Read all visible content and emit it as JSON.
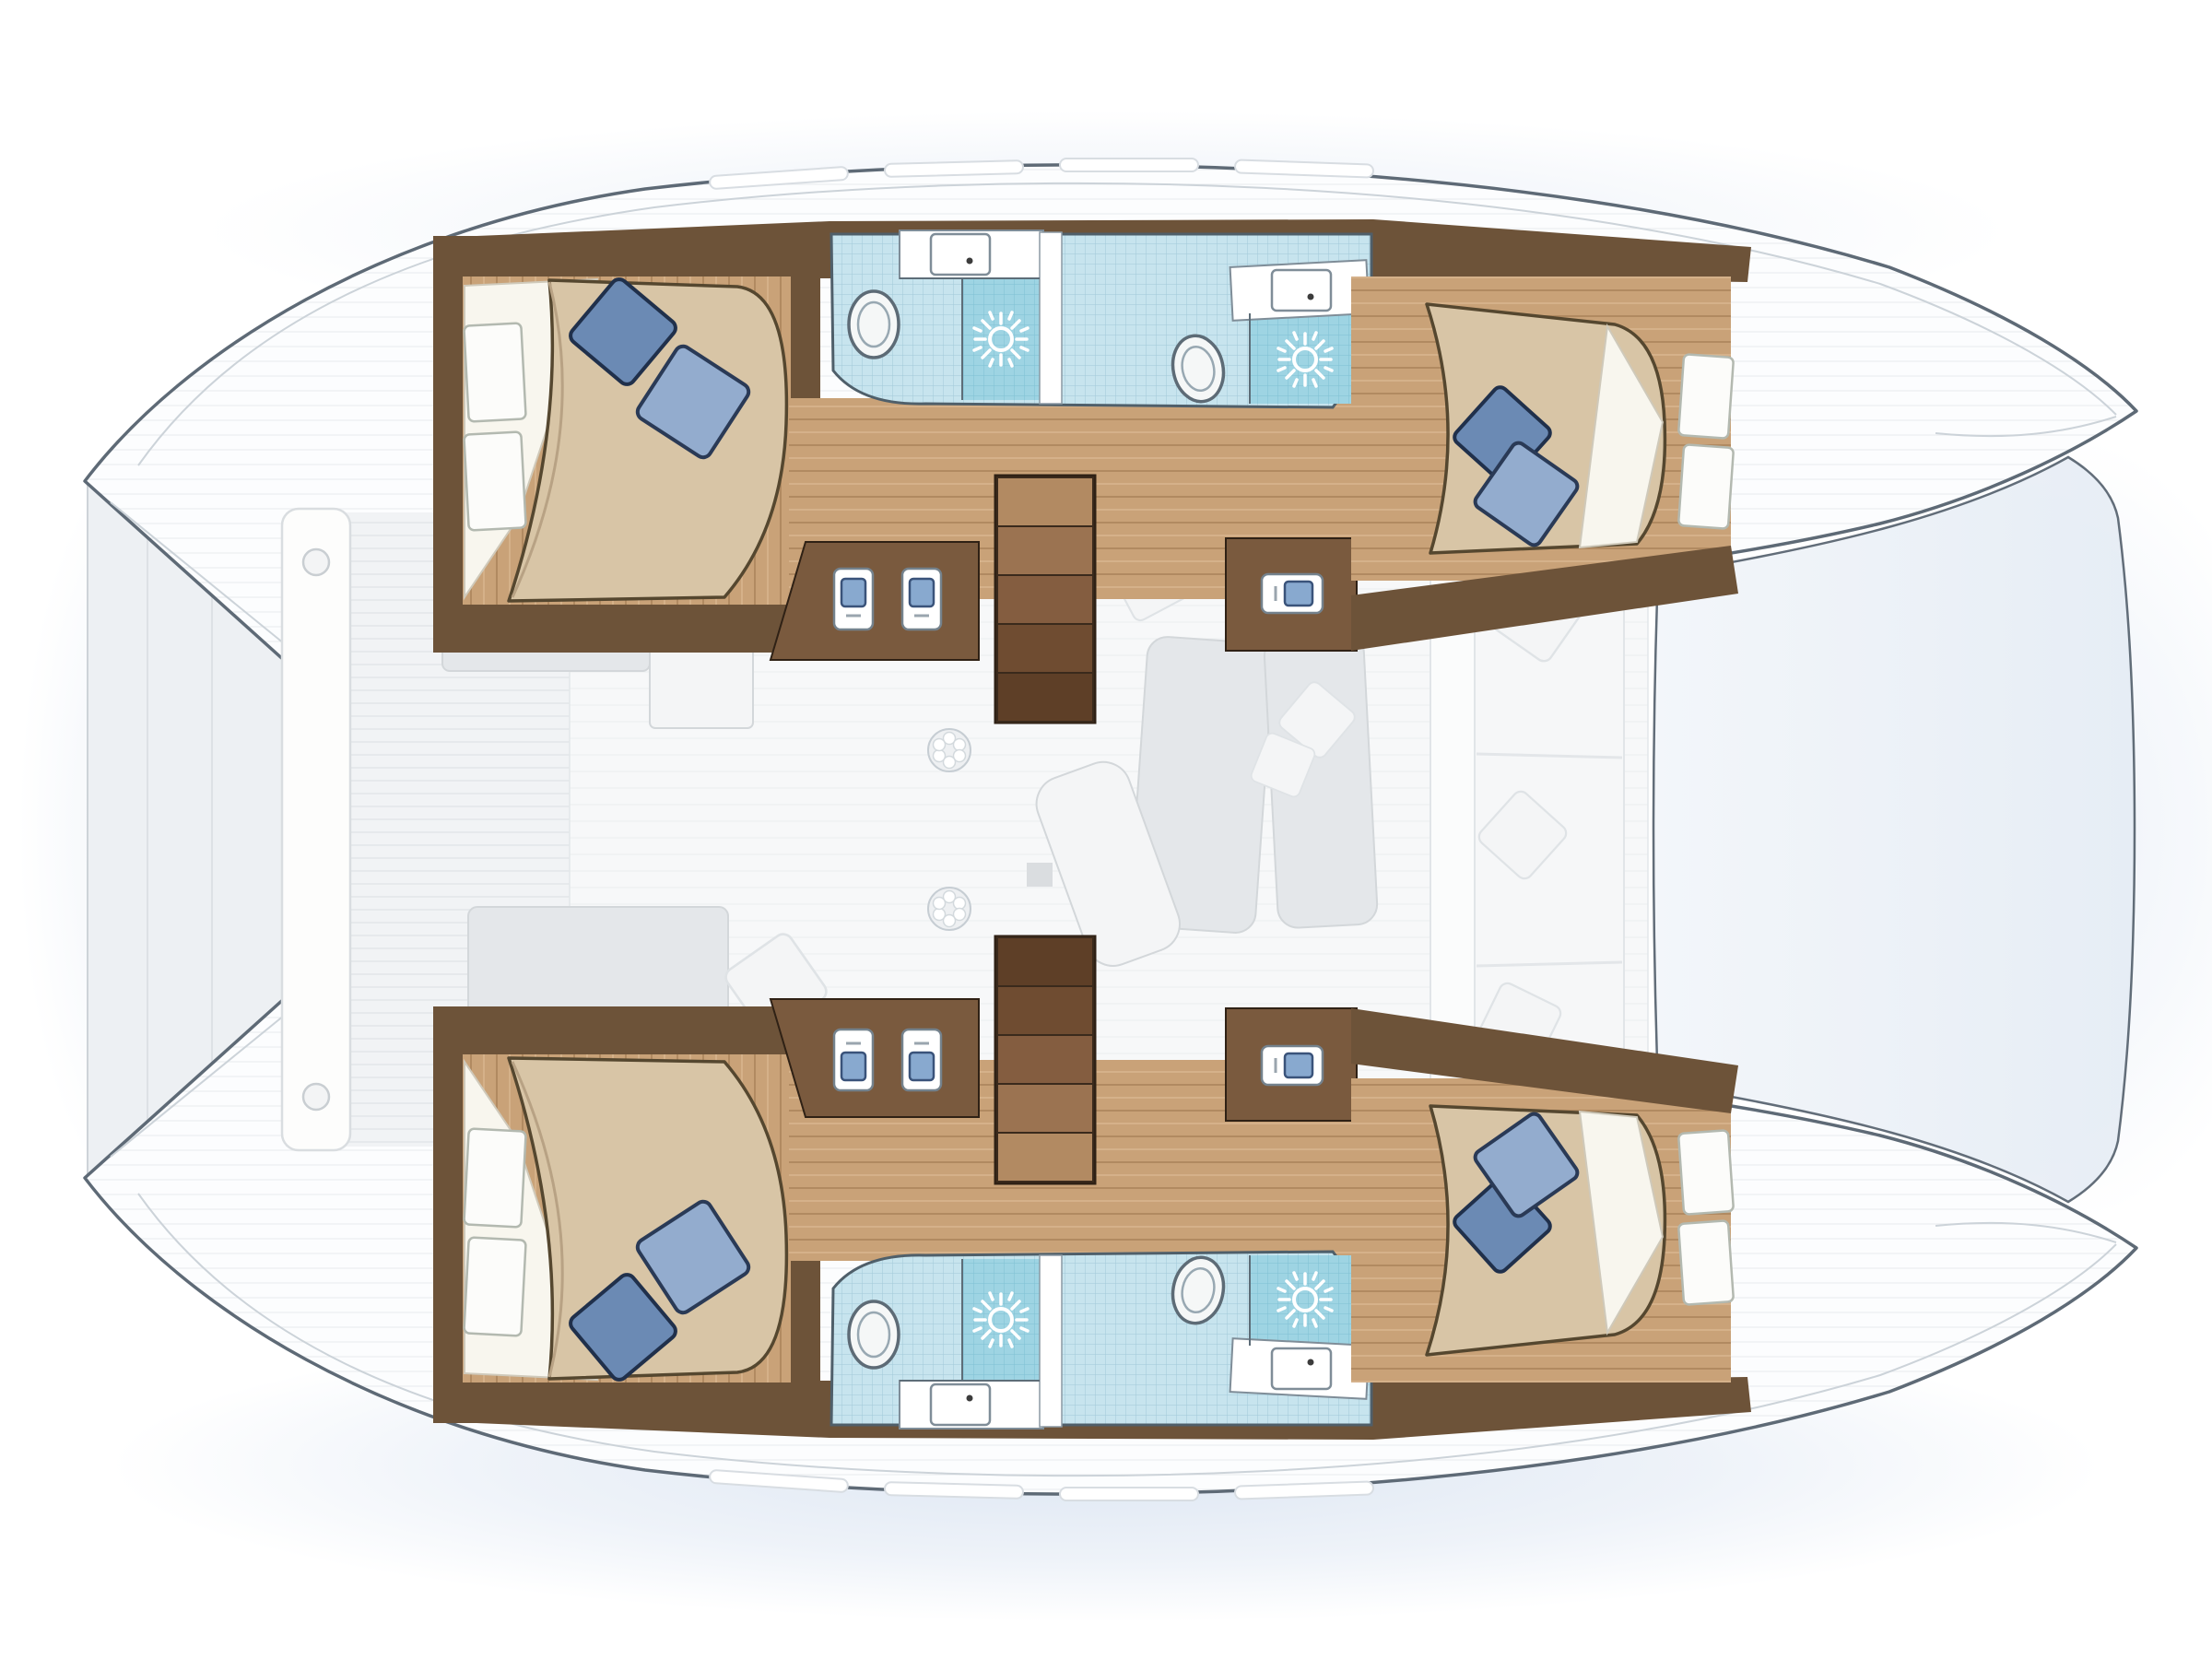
{
  "diagram": {
    "subject": "catamaran-yacht-floorplan-top-view",
    "orientation": {
      "bow": "right",
      "stern": "left"
    },
    "hulls": [
      {
        "id": "top-hull",
        "rooms": [
          {
            "name": "aft-double-cabin",
            "furniture": [
              "double-bed",
              "white-sheet",
              "pillow-dark-blue",
              "pillow-light-blue",
              "headboard-shelf",
              "headboard-shelf"
            ]
          },
          {
            "name": "aft-bathroom",
            "fixtures": [
              "toilet",
              "sink",
              "shower-sun"
            ]
          },
          {
            "name": "forward-bathroom",
            "fixtures": [
              "toilet",
              "sink",
              "shower-sun"
            ]
          },
          {
            "name": "companionway-stairs",
            "steps": 5
          },
          {
            "name": "galley-unit-double",
            "fixtures": [
              "fixture",
              "fixture"
            ]
          },
          {
            "name": "galley-unit-single",
            "fixtures": [
              "fixture"
            ]
          },
          {
            "name": "forward-double-cabin",
            "furniture": [
              "double-bed",
              "white-sheet",
              "pillow-dark-blue",
              "pillow-light-blue",
              "shelf",
              "shelf"
            ]
          }
        ]
      },
      {
        "id": "bottom-hull",
        "mirror_of": "top-hull"
      }
    ],
    "bridgedeck": {
      "aft_deck": {
        "bench": "white-plank-bench",
        "bench_circles": 2
      },
      "salon_ghost_items": [
        "sofa-block",
        "storage-box",
        "deck-hatch",
        "deck-hatch",
        "sun-pad",
        "sun-pad",
        "lounger",
        "table-base",
        "scatter-pillows",
        "daybed",
        "daybed-pillow"
      ],
      "forward_settee": {
        "cushions": 3,
        "pillows": 3
      },
      "forward_cockpit_panel": 1
    },
    "totals": {
      "cabins": 4,
      "toilets": 4,
      "sinks": 4,
      "showers": 4,
      "stairs": 2
    }
  },
  "colors": {
    "hull_outline": "#5e6a76",
    "hull_fill": "#fcfdfe",
    "deck_stripe": "#eceff1",
    "rim": "#ccd3d9",
    "shadow": "#c3d3e9",
    "wall_wood": "#6d5339",
    "alcove_wood": "#7a5a3e",
    "floor_wood": "#c9a278",
    "floor_wood_line": "#b18a61",
    "floor_wood_light": "#d9b68f",
    "mattress": "#d8c5a6",
    "mattress_outline": "#55472f",
    "sheet": "#f8f6ee",
    "pillow_dark": "#6b8ab4",
    "pillow_dark_outline": "#20304b",
    "pillow_light": "#93acce",
    "pillow_light_outline": "#2a3a56",
    "tile": "#c7e4ee",
    "tile_line": "#a0c9d8",
    "tile_shower": "#9ed4e3",
    "tile_shower_line": "#7fc0d3",
    "bath_outline": "#4f5f6a",
    "fixture_blue": "#88a9cf",
    "toilet_fill": "#f5f7f7",
    "toilet_outline": "#5d6b76",
    "stair_1": "#b28a62",
    "stair_2": "#9b7351",
    "stair_3": "#845d40",
    "stair_4": "#6f4c31",
    "stair_5": "#5e3f27",
    "stair_outline": "#2f2115",
    "ghost_fill": "#e4e7ea",
    "ghost_line": "#d3d7da",
    "ghost_white": "#f4f5f6",
    "salon_floor": "#f7f8f9",
    "salon_stripe": "#eef0f2",
    "deck_fill": "#f1f3f5",
    "fwd_panel_a": "#f3f6fa",
    "fwd_panel_b": "#e6edf5",
    "bench_white": "#fdfdfc"
  }
}
